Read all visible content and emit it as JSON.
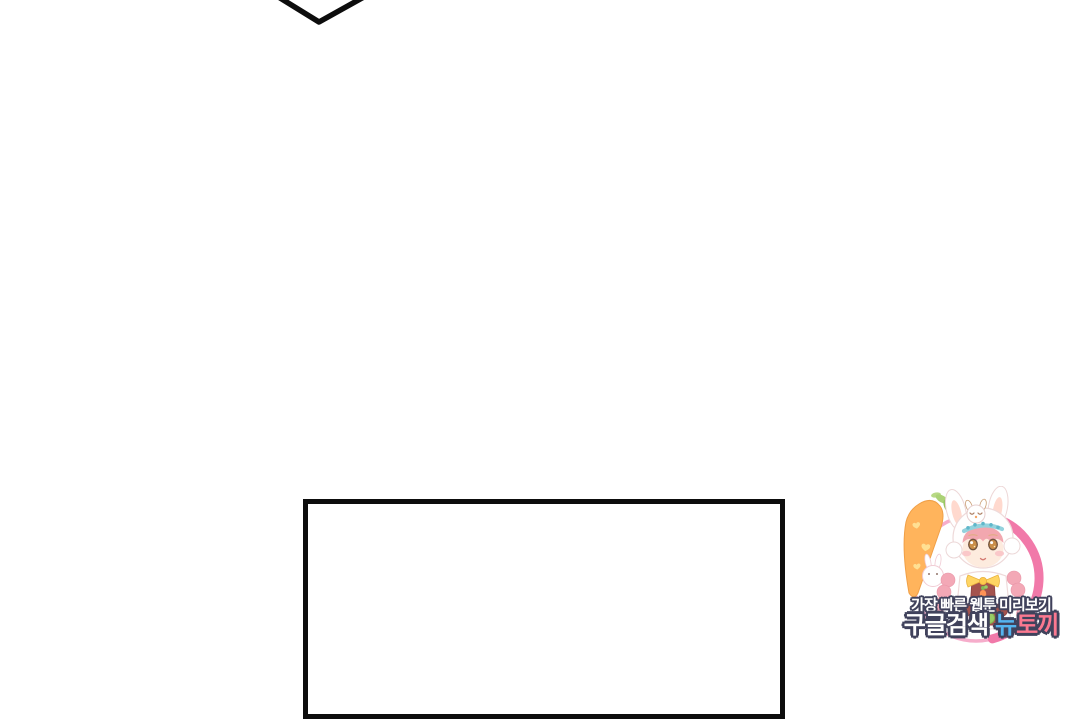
{
  "watermark": {
    "tagline": "가장 빠른 웹툰 미리보기",
    "search_label": "구글검색",
    "brand_first": "뉴",
    "brand_rest": "토끼"
  },
  "colors": {
    "panel-border": "#0d0d0d",
    "bubble-stroke": "#0d0d0d",
    "outline-navy": "#40425c",
    "brand-blue": "#54b4f0",
    "brand-pink": "#fb7890",
    "ring-pink": "#f172a5",
    "ring-light": "#f6a9c9"
  }
}
